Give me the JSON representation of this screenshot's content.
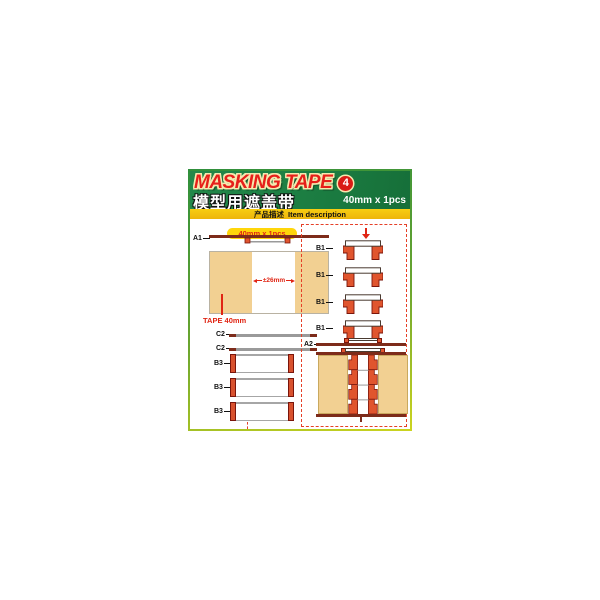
{
  "header": {
    "title": "MASKING TAPE",
    "badge": "4",
    "subtitle_cn": "模型用遮盖带",
    "spec": "40mm x 1pcs"
  },
  "description_bar": {
    "cn": "产品描述",
    "en": "Item description"
  },
  "left_panel": {
    "size_pill": "40mm x 1pcs",
    "a1_label": "A1",
    "dimension_label": "±26mm",
    "tape_label": "TAPE 40mm",
    "c2_label_1": "C2",
    "c2_label_2": "C2",
    "b3_label_1": "B3",
    "b3_label_2": "B3",
    "b3_label_3": "B3"
  },
  "right_panel": {
    "b1_label_1": "B1",
    "b1_label_2": "B1",
    "b1_label_3": "B1",
    "b1_label_4": "B1",
    "a2_label": "A2"
  },
  "colors": {
    "header_green": "#1b7c41",
    "accent_yellow": "#f5c40f",
    "title_red": "#e6201a",
    "part_orange": "#e0552e",
    "part_dark_red": "#7d2b1a",
    "tape_tan": "#f2d092",
    "dashed_red": "#e54028"
  }
}
